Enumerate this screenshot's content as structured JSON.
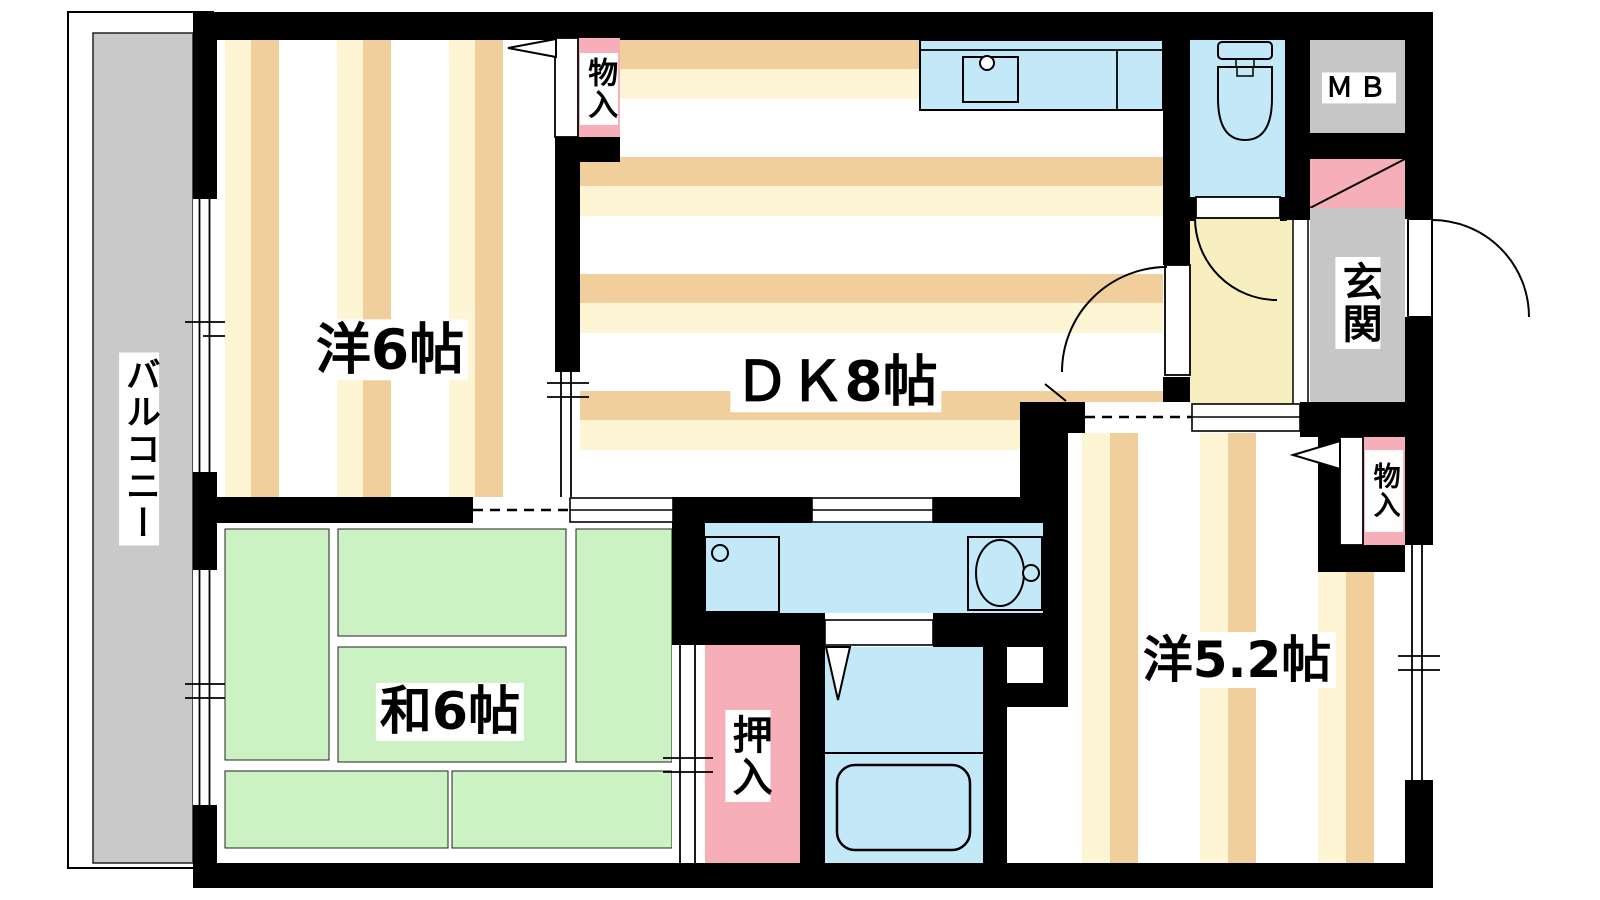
{
  "title": "2DK apartment floor plan",
  "labels": {
    "balcony": "バルコニー",
    "western_6": "洋6帖",
    "dk_8": "ＤＫ8帖",
    "japanese_6": "和6帖",
    "western_5_2": "洋5.2帖",
    "oshiire": "押入",
    "storage_top": "物入",
    "storage_right": "物入",
    "entrance": "玄関",
    "meter_box": "ＭＢ"
  },
  "colors": {
    "wall": "#000000",
    "balcony_gray": "#c9c9c9",
    "entry_gray": "#c6c6c6",
    "tatami_green": "#ccf2c3",
    "water_blue": "#c3e8f7",
    "closet_pink": "#f6aeb8",
    "hall_cream": "#f8efc0",
    "stripe_cream": "#fdf5d3",
    "stripe_tan": "#f0cf9c"
  }
}
